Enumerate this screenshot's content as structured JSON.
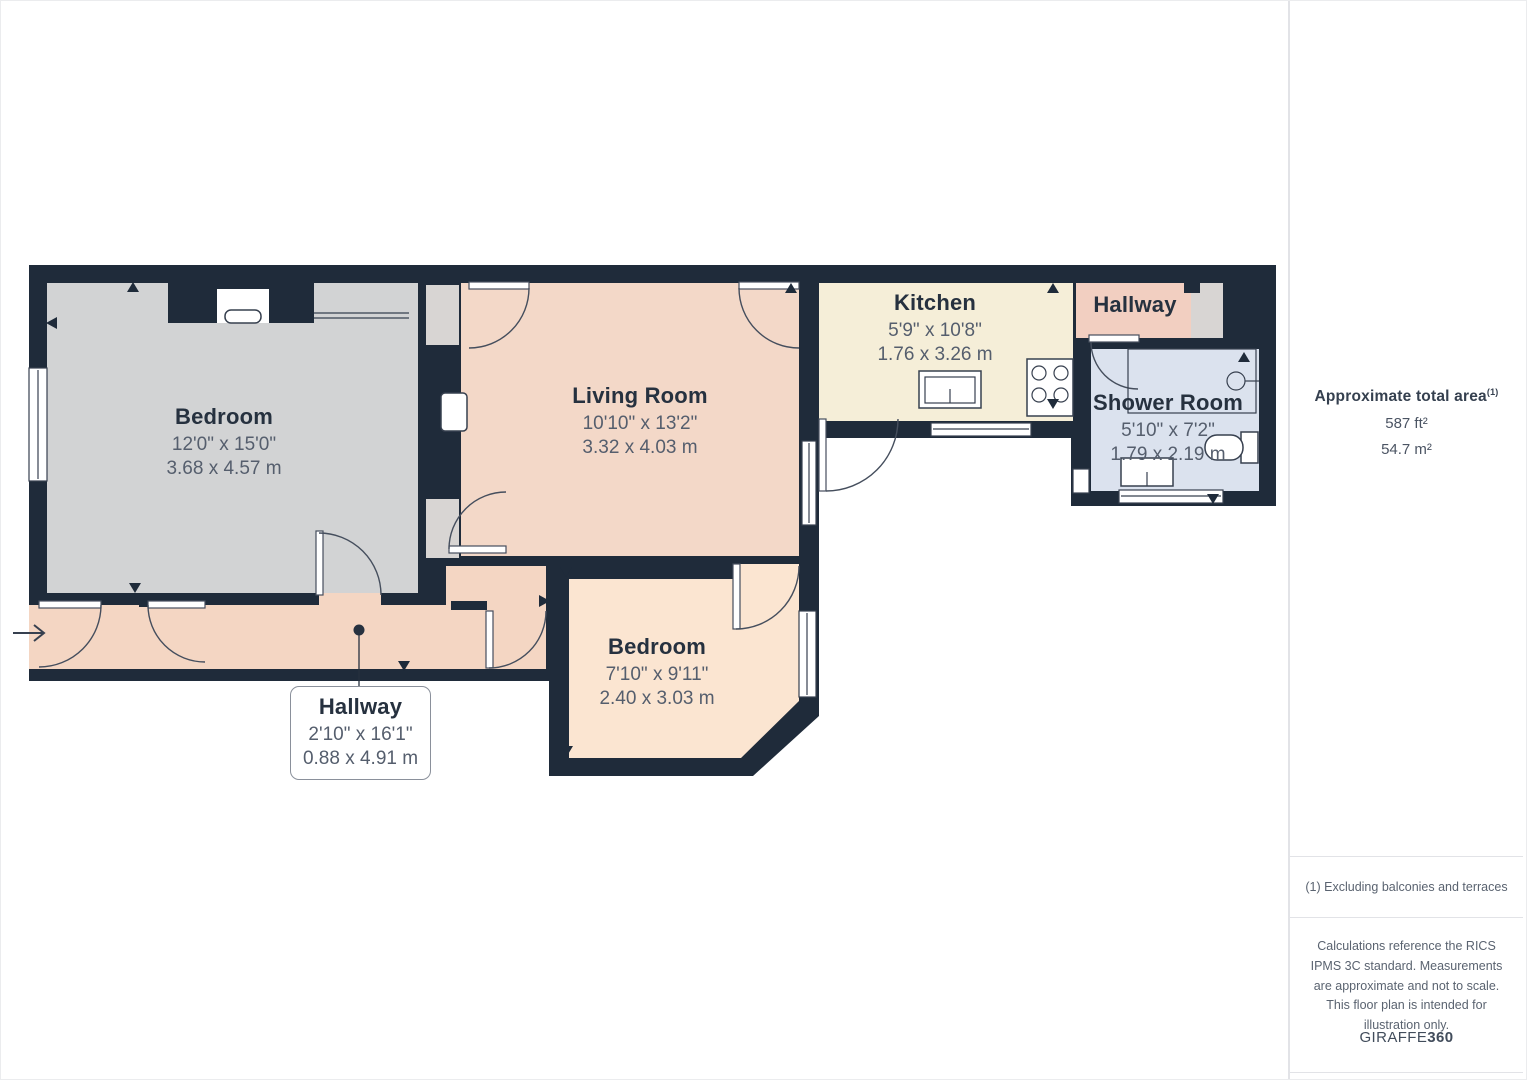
{
  "plan": {
    "colors": {
      "wall": "#1f2b3a",
      "bedroom": "#d2d3d4",
      "living": "#f3d8c8",
      "kitchen": "#f5eed8",
      "hallwayTop": "#f2cfc1",
      "hallwayBottom": "#f4d6c3",
      "shower": "#dbe2ee",
      "bedroom2": "#fbe5d1",
      "grayArea": "#d8d5d3",
      "white": "#ffffff"
    },
    "rooms": [
      {
        "id": "bedroom-left",
        "name": "Bedroom",
        "imperial": "12'0\" x 15'0\"",
        "metric": "3.68 x 4.57 m"
      },
      {
        "id": "living-room",
        "name": "Living Room",
        "imperial": "10'10\" x 13'2\"",
        "metric": "3.32 x 4.03 m"
      },
      {
        "id": "kitchen",
        "name": "Kitchen",
        "imperial": "5'9\" x 10'8\"",
        "metric": "1.76 x 3.26 m"
      },
      {
        "id": "hallway-top",
        "name": "Hallway",
        "imperial": "",
        "metric": ""
      },
      {
        "id": "shower-room",
        "name": "Shower Room",
        "imperial": "5'10\" x 7'2\"",
        "metric": "1.79 x 2.19 m"
      },
      {
        "id": "bedroom-bottom",
        "name": "Bedroom",
        "imperial": "7'10\" x 9'11\"",
        "metric": "2.40 x 3.03 m"
      },
      {
        "id": "hallway-bottom",
        "name": "Hallway",
        "imperial": "2'10\" x 16'1\"",
        "metric": "0.88 x 4.91 m"
      }
    ]
  },
  "sidebar": {
    "area_title": "Approximate total area",
    "area_superscript": "(1)",
    "area_ft": "587 ft²",
    "area_m": "54.7 m²",
    "footnote": "(1) Excluding balconies and terraces",
    "disclaimer": "Calculations reference the RICS IPMS 3C standard. Measurements are approximate and not to scale. This floor plan is intended for illustration only.",
    "brand_normal": "GIRAFFE",
    "brand_bold": "360"
  }
}
